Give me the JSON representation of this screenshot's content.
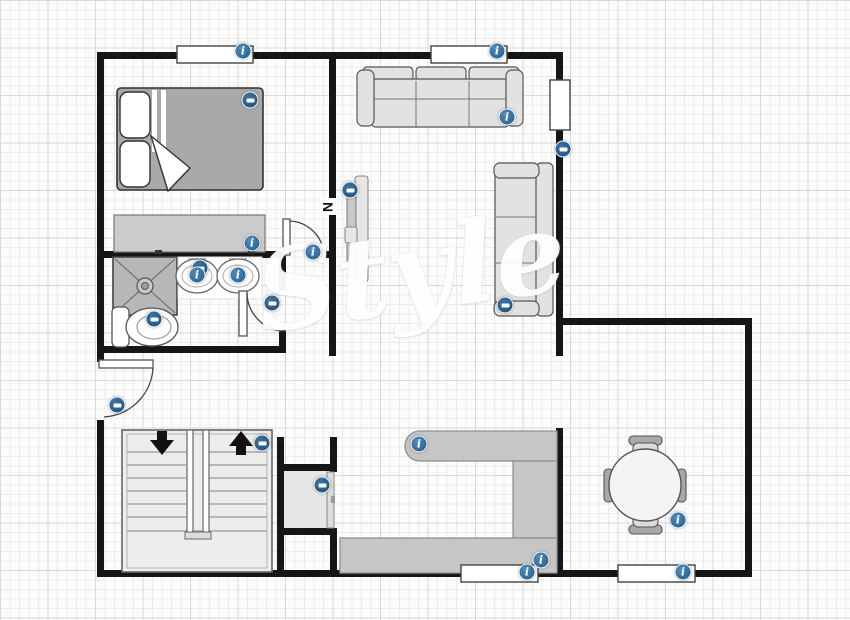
{
  "app": {
    "watermark": "Style",
    "compass_label": "N"
  },
  "colors": {
    "wall": "#161616",
    "grid_minor": "#ebebea",
    "grid_major": "#d8d8d8",
    "icon_info_blue": "#2f6ea6",
    "icon_feature_blue": "#1d5c8f",
    "furniture_fill": "#e2e2e0",
    "counter_fill": "#c6c6c4",
    "bed_blanket": "#a9a9a9",
    "shower_fill": "#b7b7b5",
    "stairs_fill": "#ededeb"
  },
  "icons": [
    {
      "name": "window-bedroom-top-icon",
      "kind": "info",
      "glyph": "i",
      "x": 243,
      "y": 51
    },
    {
      "name": "window-living-top-icon",
      "kind": "info",
      "glyph": "i",
      "x": 497,
      "y": 51
    },
    {
      "name": "bed-icon",
      "kind": "feature",
      "glyph": "",
      "x": 250,
      "y": 100
    },
    {
      "name": "sofa-living-icon",
      "kind": "info",
      "glyph": "i",
      "x": 507,
      "y": 117
    },
    {
      "name": "window-living-right-icon",
      "kind": "feature",
      "glyph": "",
      "x": 563,
      "y": 149
    },
    {
      "name": "tv-icon",
      "kind": "feature",
      "glyph": "",
      "x": 350,
      "y": 190
    },
    {
      "name": "dresser-icon",
      "kind": "info",
      "glyph": "i",
      "x": 252,
      "y": 243
    },
    {
      "name": "bedroom-door-icon",
      "kind": "info",
      "glyph": "i",
      "x": 313,
      "y": 252
    },
    {
      "name": "shower-icon",
      "kind": "feature",
      "glyph": "",
      "x": 200,
      "y": 268
    },
    {
      "name": "sink-left-icon",
      "kind": "info",
      "glyph": "i",
      "x": 197,
      "y": 275
    },
    {
      "name": "sink-right-icon",
      "kind": "info",
      "glyph": "i",
      "x": 238,
      "y": 275
    },
    {
      "name": "bathroom-door-icon",
      "kind": "feature",
      "glyph": "",
      "x": 272,
      "y": 303
    },
    {
      "name": "sofa-right-icon",
      "kind": "feature",
      "glyph": "",
      "x": 505,
      "y": 305
    },
    {
      "name": "toilet-icon",
      "kind": "feature",
      "glyph": "",
      "x": 154,
      "y": 319
    },
    {
      "name": "front-door-icon",
      "kind": "feature",
      "glyph": "",
      "x": 117,
      "y": 405
    },
    {
      "name": "stairs-icon",
      "kind": "feature",
      "glyph": "",
      "x": 262,
      "y": 443
    },
    {
      "name": "kitchen-counter-icon",
      "kind": "info",
      "glyph": "i",
      "x": 419,
      "y": 444
    },
    {
      "name": "closet-door-icon",
      "kind": "feature",
      "glyph": "",
      "x": 322,
      "y": 485
    },
    {
      "name": "dining-table-icon",
      "kind": "info",
      "glyph": "i",
      "x": 678,
      "y": 520
    },
    {
      "name": "kitchen-extra-icon",
      "kind": "info",
      "glyph": "i",
      "x": 541,
      "y": 560
    },
    {
      "name": "window-kitchen-bottom-icon",
      "kind": "info",
      "glyph": "i",
      "x": 527,
      "y": 572
    },
    {
      "name": "window-dining-bottom-icon",
      "kind": "info",
      "glyph": "i",
      "x": 683,
      "y": 572
    }
  ]
}
